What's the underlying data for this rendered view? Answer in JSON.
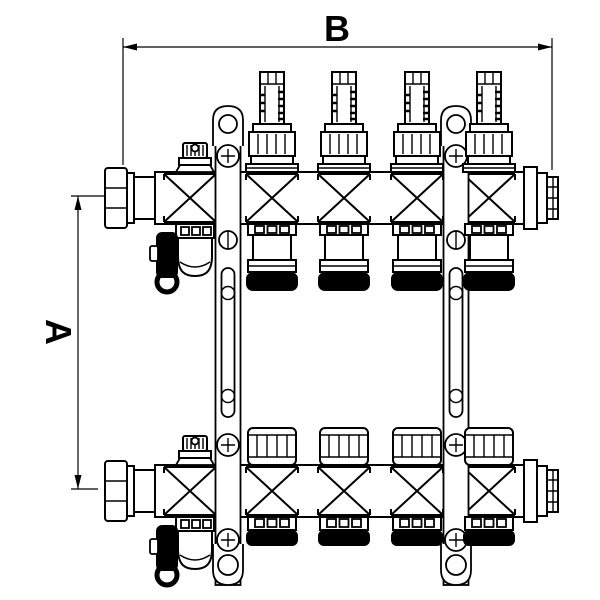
{
  "title": "Heating manifold technical drawing",
  "dimension_labels": {
    "width": "B",
    "height": "A"
  },
  "drawing": {
    "type": "technical-line-drawing",
    "subject": "brass underfloor-heating manifold, front view, two rails",
    "circuit_count": 4,
    "colors": {
      "line": "#000000",
      "background": "#ffffff",
      "seal": "#000000"
    },
    "components": [
      "union-nut",
      "flow-meter-sight-glass",
      "flow-meter-adjust-collar",
      "valve-body",
      "thermostatic-valve-cap",
      "euroconus-outlet",
      "air-vent-valve",
      "drain-valve-with-cap",
      "mounting-bracket",
      "threaded-end-fitting"
    ]
  }
}
